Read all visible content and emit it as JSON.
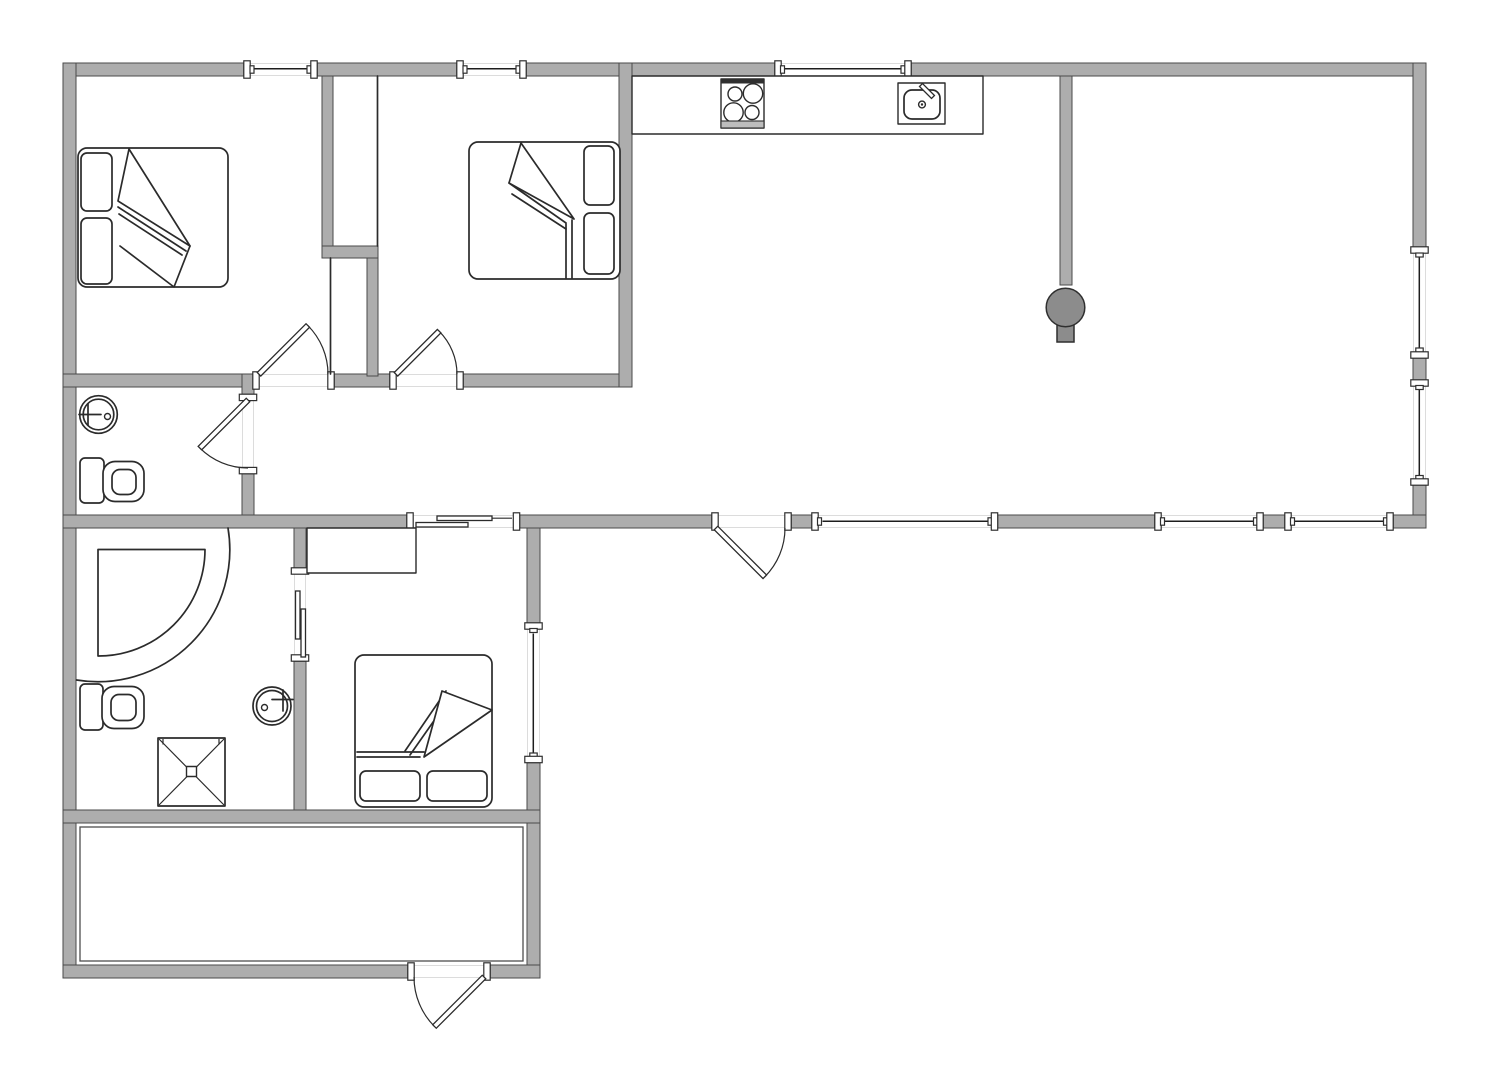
{
  "document": {
    "kind": "architectural-floor-plan",
    "canvas": {
      "width": 1502,
      "height": 1086,
      "background": "#ffffff"
    },
    "visible_text": []
  },
  "colors": {
    "background": "#ffffff",
    "wall_fill": "#adadad",
    "wall_outline": "#4a4a4a",
    "fixture_line": "#2b2b2b",
    "window_glazing": "#1d1d1d",
    "wood_stove_fill": "#8c8c8c",
    "guide_line": "#dcdcdc"
  },
  "rooms": [
    {
      "id": "bedroom-1",
      "position": "top-left",
      "fixtures": [
        "double-bed",
        "wardrobe-niche",
        "swing-door"
      ]
    },
    {
      "id": "bedroom-2",
      "position": "top-middle",
      "fixtures": [
        "double-bed",
        "wardrobe-niche",
        "swing-door"
      ]
    },
    {
      "id": "living-kitchen",
      "position": "right",
      "fixtures": [
        "kitchen-counter",
        "cooktop",
        "kitchen-sink",
        "wood-stove",
        "exterior-door"
      ]
    },
    {
      "id": "hallway",
      "position": "center-left"
    },
    {
      "id": "bathroom-1",
      "position": "middle-left",
      "fixtures": [
        "round-washbasin",
        "toilet",
        "swing-door"
      ]
    },
    {
      "id": "bathroom-2",
      "position": "bottom-left",
      "fixtures": [
        "corner-shower",
        "toilet",
        "round-washbasin",
        "shower-tray",
        "sliding-door"
      ]
    },
    {
      "id": "bedroom-3",
      "position": "bottom-middle",
      "fixtures": [
        "double-bed",
        "closet",
        "sliding-door",
        "window"
      ]
    },
    {
      "id": "terrace-entry",
      "position": "bottom",
      "fixtures": [
        "exterior-door",
        "inner-floor-outline"
      ]
    }
  ],
  "openings": {
    "windows_top_wall": 3,
    "windows_right_wall": 2,
    "windows_bottom_wall": 3,
    "windows_wing_wall": 1,
    "swing_doors": 5,
    "sliding_doors": 2
  },
  "icons": [
    "double-bed-icon",
    "pillow-icon",
    "blanket-fold-icon",
    "cooktop-icon",
    "kitchen-sink-icon",
    "faucet-icon",
    "wood-stove-icon",
    "toilet-icon",
    "round-washbasin-icon",
    "corner-shower-icon",
    "shower-tray-icon",
    "door-swing-icon",
    "sliding-door-icon",
    "window-icon",
    "wall-cap-icon"
  ]
}
